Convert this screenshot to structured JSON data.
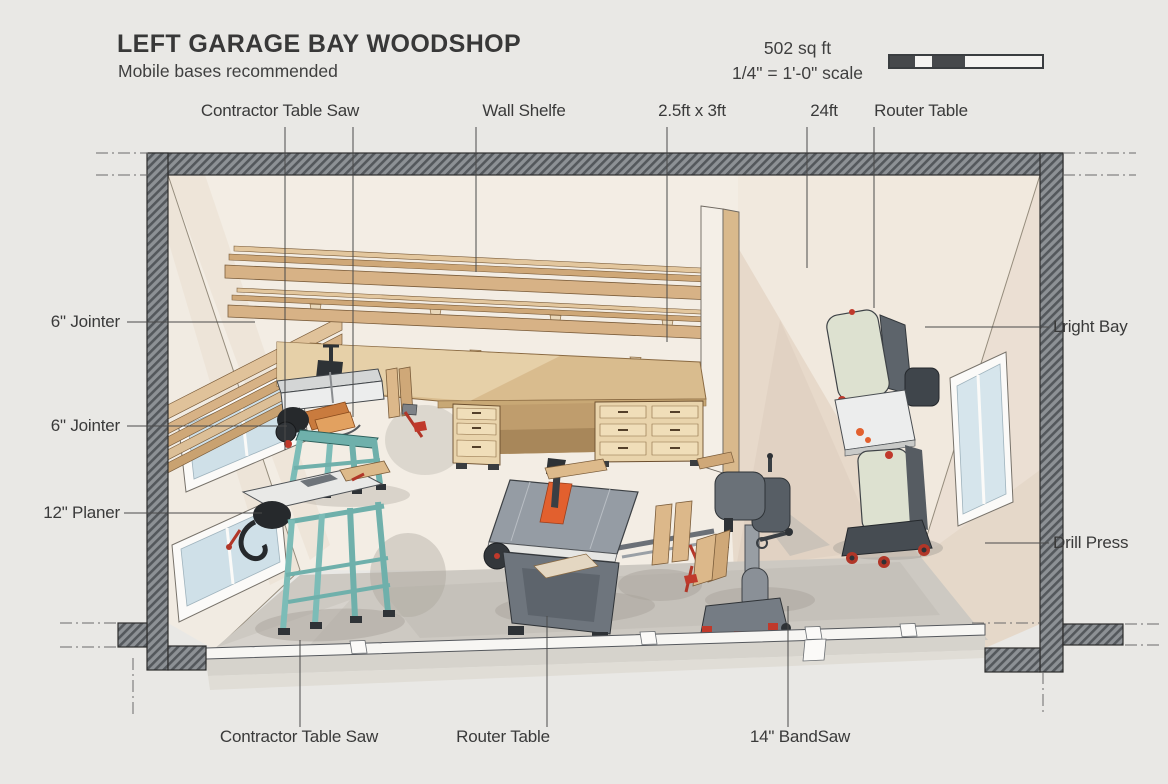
{
  "title": "LEFT GARAGE BAY WOODSHOP",
  "subtitle": "Mobile bases recommended",
  "info": {
    "area": "502 sq ft",
    "scale": "1/4\" = 1'-0\" scale"
  },
  "labels": {
    "top": [
      {
        "text": "Contractor Table Saw"
      },
      {
        "text": "Wall Shelfe"
      },
      {
        "text": "2.5ft x 3ft"
      },
      {
        "text": "24ft"
      },
      {
        "text": "Router Table"
      }
    ],
    "left": [
      {
        "text": "6\" Jointer"
      },
      {
        "text": "6\" Jointer"
      },
      {
        "text": "12\" Planer"
      }
    ],
    "right": [
      {
        "text": "Lright Bay"
      },
      {
        "text": "Drill Press"
      }
    ],
    "bottom": [
      {
        "text": "Contractor Table Saw"
      },
      {
        "text": "Router Table"
      },
      {
        "text": "14\" BandSaw"
      }
    ]
  },
  "colors": {
    "background": "#e9e8e5",
    "text": "#3a3a3a",
    "wall_fill": "#8d9195",
    "wall_hatch": "#54585c",
    "back_wall": "#f3ede4",
    "right_wall": "#ebdfd3",
    "floor": "#cdc9c2",
    "wood": "#d7b286",
    "machine_teal": "#79b8b3",
    "machine_gray": "#6e757d",
    "bandsaw_sage": "#dde1d0",
    "accent_orange": "#e2602e",
    "accent_red": "#c0392b",
    "window_glass": "#cfe0e8"
  }
}
